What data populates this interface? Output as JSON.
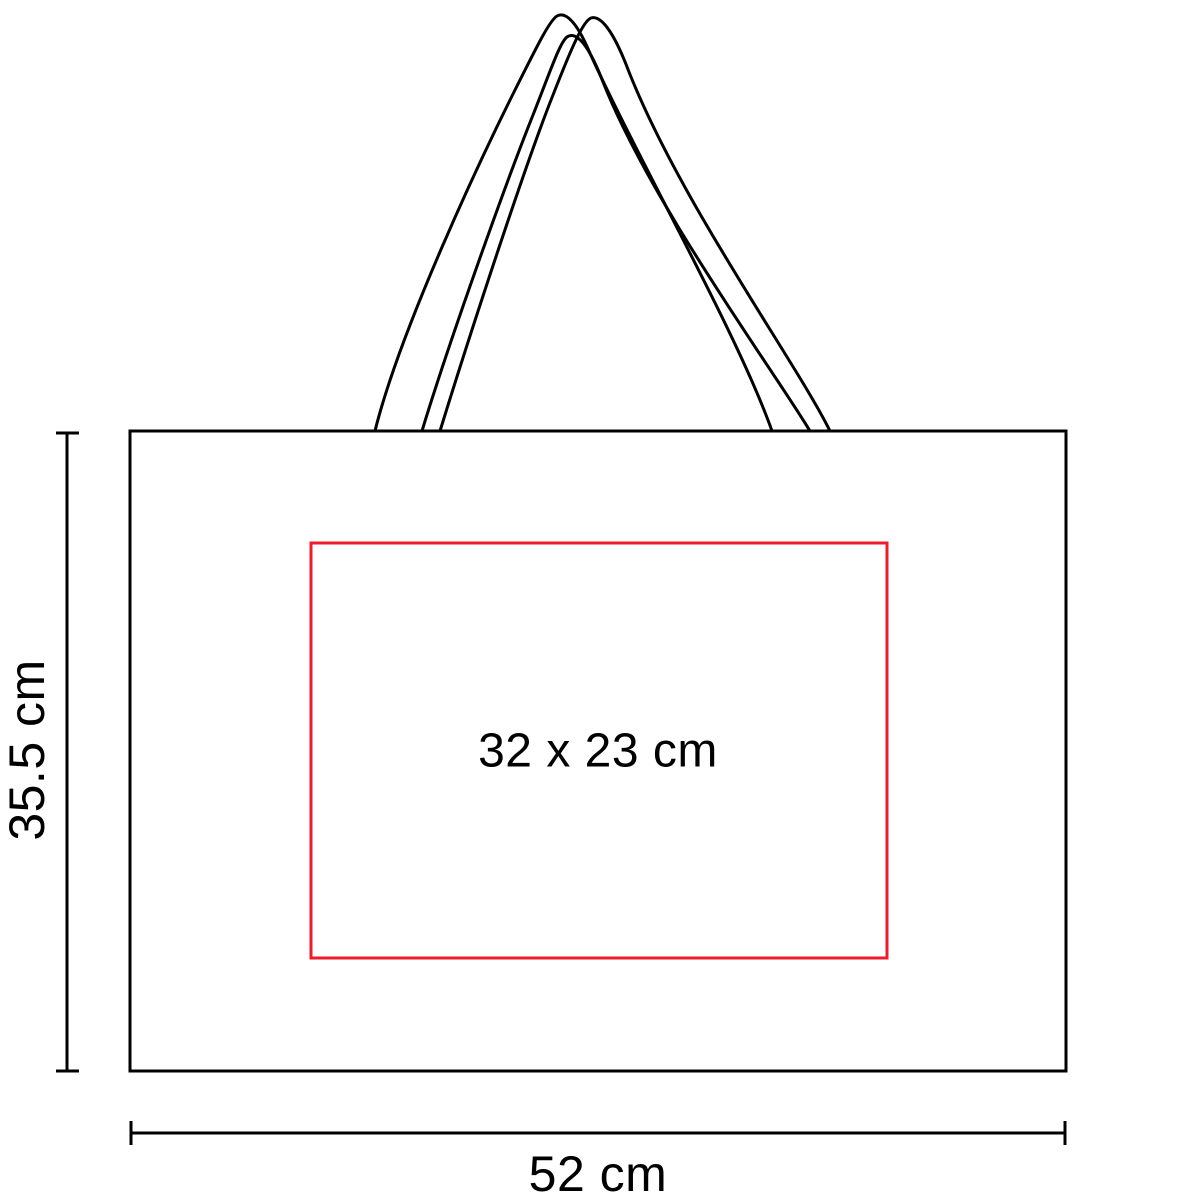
{
  "labels": {
    "bag_height": "35.5 cm",
    "bag_width": "52 cm",
    "print_area": "32 x 23 cm"
  },
  "colors": {
    "outline": "#000000",
    "print_area_border": "#ee1c2c",
    "text": "#000000",
    "background": "#ffffff"
  }
}
